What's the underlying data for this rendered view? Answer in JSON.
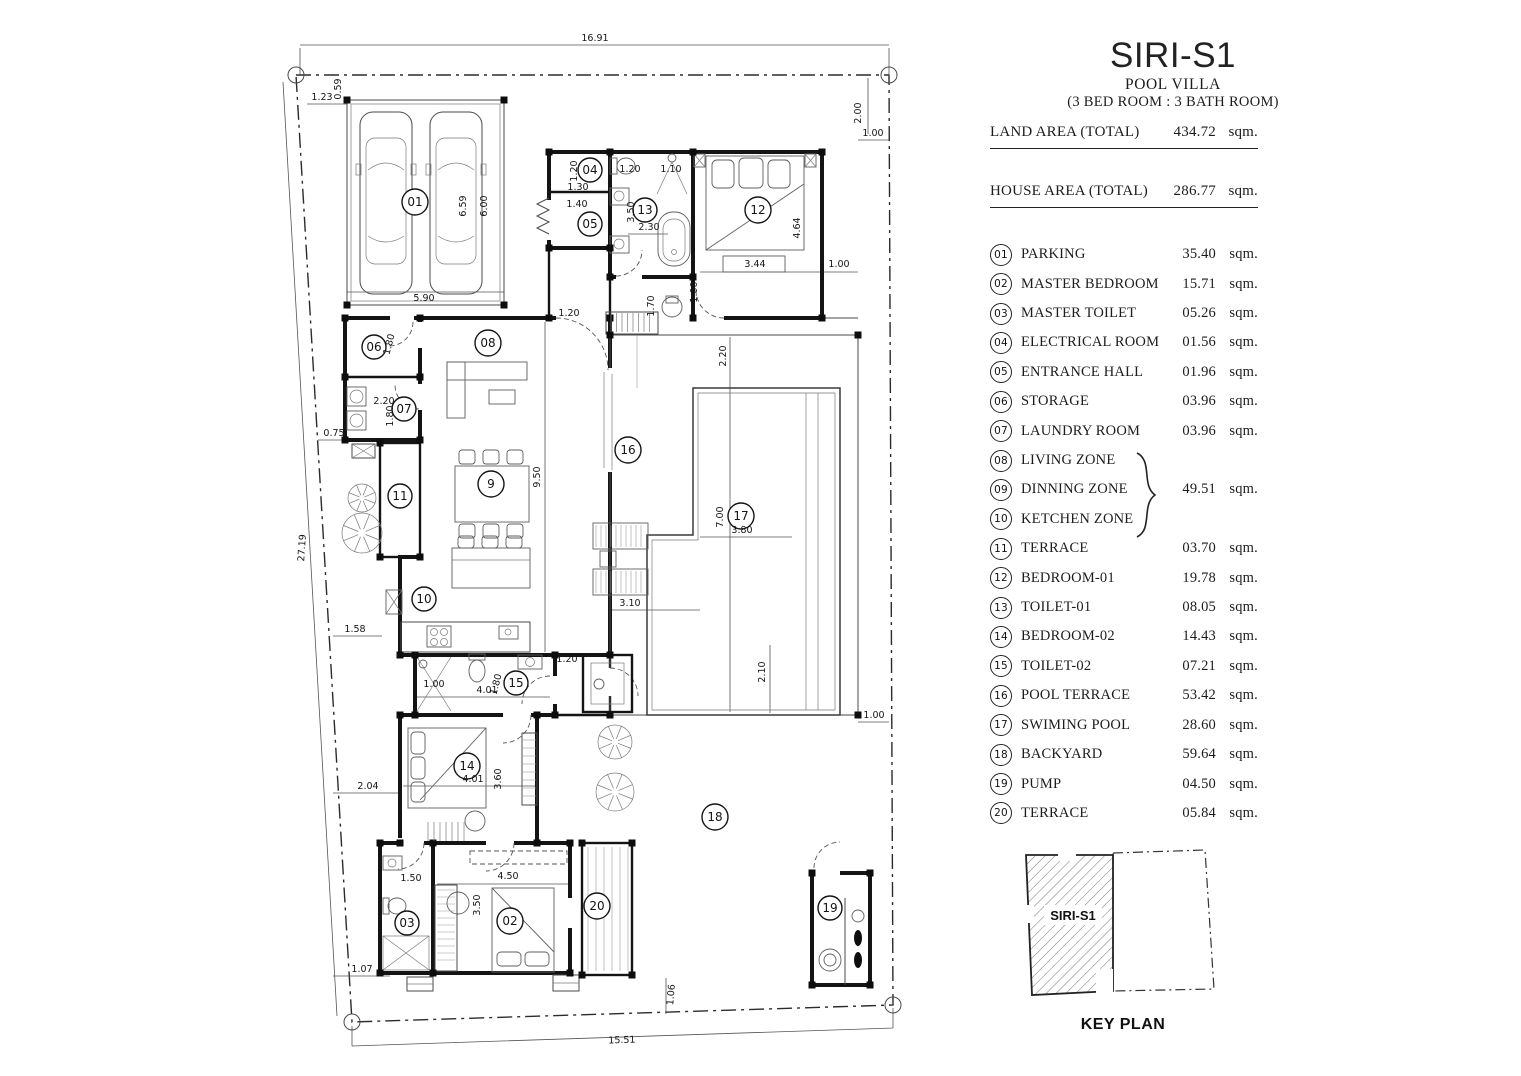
{
  "title_block": {
    "title": "SIRI-S1",
    "subtitle": "POOL VILLA",
    "spec": "(3 BED ROOM : 3 BATH ROOM)",
    "land": {
      "label": "LAND AREA (TOTAL)",
      "value": "434.72",
      "unit": "sqm."
    },
    "house": {
      "label": "HOUSE AREA (TOTAL)",
      "value": "286.77",
      "unit": "sqm."
    }
  },
  "schedule": {
    "rows": [
      {
        "no": "01",
        "label": "PARKING",
        "area": "35.40",
        "unit": "sqm."
      },
      {
        "no": "02",
        "label": "MASTER BEDROOM",
        "area": "15.71",
        "unit": "sqm."
      },
      {
        "no": "03",
        "label": "MASTER TOILET",
        "area": "05.26",
        "unit": "sqm."
      },
      {
        "no": "04",
        "label": "ELECTRICAL ROOM",
        "area": "01.56",
        "unit": "sqm."
      },
      {
        "no": "05",
        "label": "ENTRANCE HALL",
        "area": "01.96",
        "unit": "sqm."
      },
      {
        "no": "06",
        "label": "STORAGE",
        "area": "03.96",
        "unit": "sqm."
      },
      {
        "no": "07",
        "label": "LAUNDRY ROOM",
        "area": "03.96",
        "unit": "sqm."
      },
      {
        "no": "08",
        "label": "LIVING ZONE",
        "area": "",
        "unit": ""
      },
      {
        "no": "09",
        "label": "DINNING ZONE",
        "area": "49.51",
        "unit": "sqm."
      },
      {
        "no": "10",
        "label": "KETCHEN ZONE",
        "area": "",
        "unit": ""
      },
      {
        "no": "11",
        "label": "TERRACE",
        "area": "03.70",
        "unit": "sqm."
      },
      {
        "no": "12",
        "label": "BEDROOM-01",
        "area": "19.78",
        "unit": "sqm."
      },
      {
        "no": "13",
        "label": "TOILET-01",
        "area": "08.05",
        "unit": "sqm."
      },
      {
        "no": "14",
        "label": "BEDROOM-02",
        "area": "14.43",
        "unit": "sqm."
      },
      {
        "no": "15",
        "label": "TOILET-02",
        "area": "07.21",
        "unit": "sqm."
      },
      {
        "no": "16",
        "label": "POOL TERRACE",
        "area": "53.42",
        "unit": "sqm."
      },
      {
        "no": "17",
        "label": "SWIMING POOL",
        "area": "28.60",
        "unit": "sqm."
      },
      {
        "no": "18",
        "label": "BACKYARD",
        "area": "59.64",
        "unit": "sqm."
      },
      {
        "no": "19",
        "label": "PUMP",
        "area": "04.50",
        "unit": "sqm."
      },
      {
        "no": "20",
        "label": "TERRACE",
        "area": "05.84",
        "unit": "sqm."
      }
    ]
  },
  "key_plan": {
    "caption": "KEY PLAN",
    "unit_label": "SIRI-S1"
  },
  "plan": {
    "markers": [
      "01",
      "04",
      "05",
      "13",
      "12",
      "06",
      "07",
      "08",
      "9",
      "11",
      "10",
      "16",
      "17",
      "15",
      "14",
      "02",
      "03",
      "20",
      "18",
      "19"
    ],
    "dims": [
      "16.91",
      "1.23",
      "0.59",
      "2.00",
      "1.00",
      "27.19",
      "15.51",
      "5.90",
      "6.59",
      "6.00",
      "1.20",
      "1.30",
      "1.40",
      "1.20",
      "1.10",
      "3.50",
      "2.30",
      "3.44",
      "4.64",
      "1.00",
      "1.70",
      "1.00",
      "1.20",
      "2.20",
      "9.50",
      "1.80",
      "2.20",
      "1.80",
      "0.75",
      "7.00",
      "3.80",
      "3.10",
      "1.58",
      "1.20",
      "1.00",
      "4.01",
      "1.80",
      "2.04",
      "4.01",
      "3.60",
      "4.50",
      "3.50",
      "1.50",
      "1.07",
      "2.10",
      "1.00",
      "1.06"
    ]
  }
}
